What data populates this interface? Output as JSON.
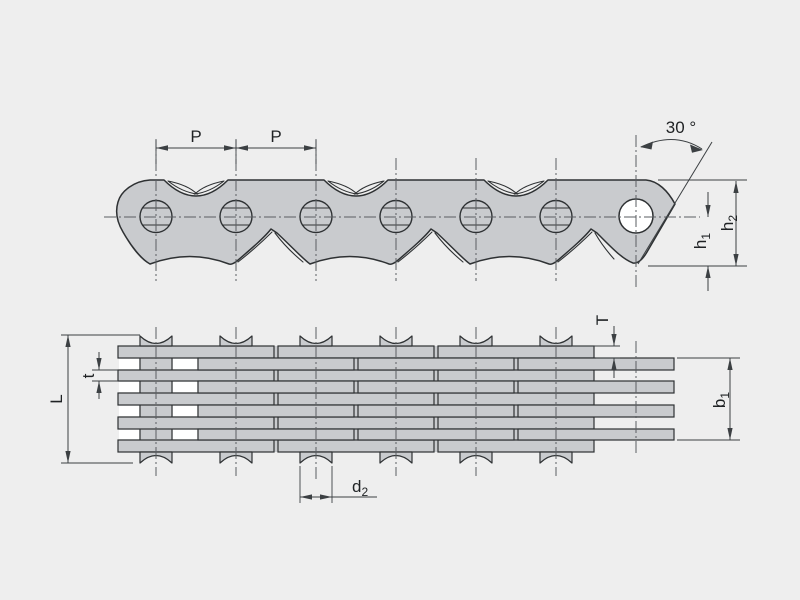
{
  "colors": {
    "background": "#eeeeee",
    "plate": "#c9cbce",
    "outline": "#2e3133",
    "dim": "#3c4043",
    "center": "#5a5e62",
    "hole": "#ffffff",
    "text": "#1f2224"
  },
  "side_view": {
    "pitch_label_a": "P",
    "pitch_label_b": "P",
    "angle_label": "30 °",
    "h1": {
      "base": "h",
      "sub": "1"
    },
    "h2": {
      "base": "h",
      "sub": "2"
    }
  },
  "plan_view": {
    "length_label": "L",
    "plate_thickness_label": "t",
    "guide_plate_thickness_label": "T",
    "b1": {
      "base": "b",
      "sub": "1"
    },
    "d2": {
      "base": "d",
      "sub": "2"
    }
  }
}
